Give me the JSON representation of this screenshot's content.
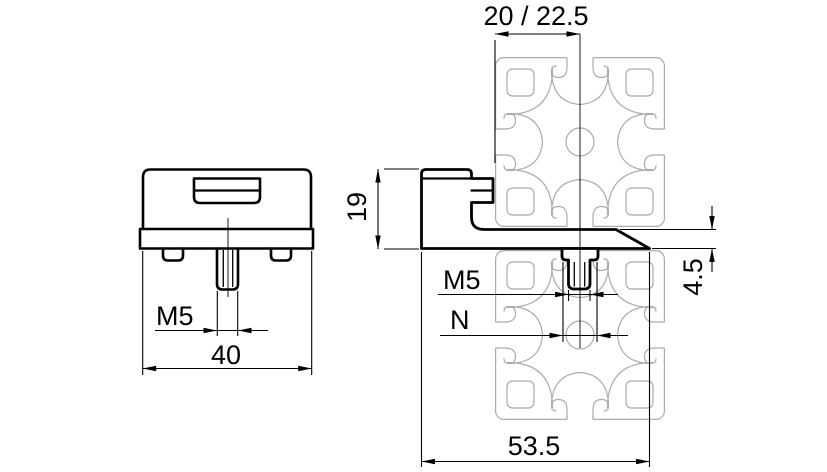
{
  "drawing": {
    "type": "technical_drawing",
    "subject": "clamp bracket with M5 stud mounted on aluminium T-slot profile",
    "colors": {
      "lines": "#000000",
      "profile": "#ababab",
      "background": "#ffffff"
    },
    "views": {
      "front": {
        "name": "front view of bracket",
        "dims": {
          "thread": "M5",
          "width": "40"
        }
      },
      "side": {
        "name": "side view on profile",
        "dims": {
          "slot_offset": "20 / 22.5",
          "height": "19",
          "plate_thickness": "4.5",
          "thread": "M5",
          "slot_opening": "N",
          "depth": "53.5"
        }
      }
    }
  }
}
